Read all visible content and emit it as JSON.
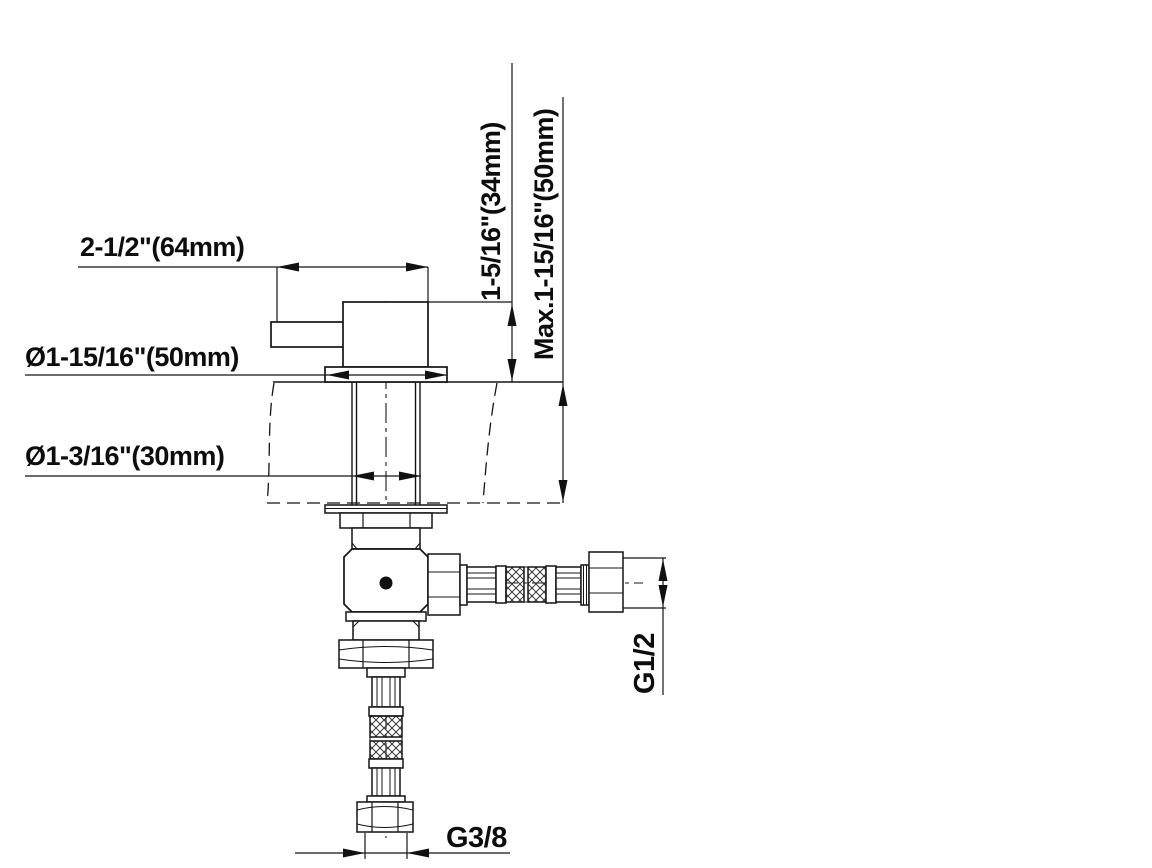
{
  "diagram": {
    "labels": {
      "handle_width": "2-1/2\"(64mm)",
      "body_height": "1-5/16\"(34mm)",
      "max_deck_thickness": "Max.1-15/16\"(50mm)",
      "flange_diameter": "Ø1-15/16\"(50mm)",
      "shank_diameter": "Ø1-3/16\"(30mm)",
      "hose_thread": "G1/2",
      "supply_thread": "G3/8"
    },
    "colors": {
      "line": "#111111",
      "background": "#ffffff"
    }
  }
}
